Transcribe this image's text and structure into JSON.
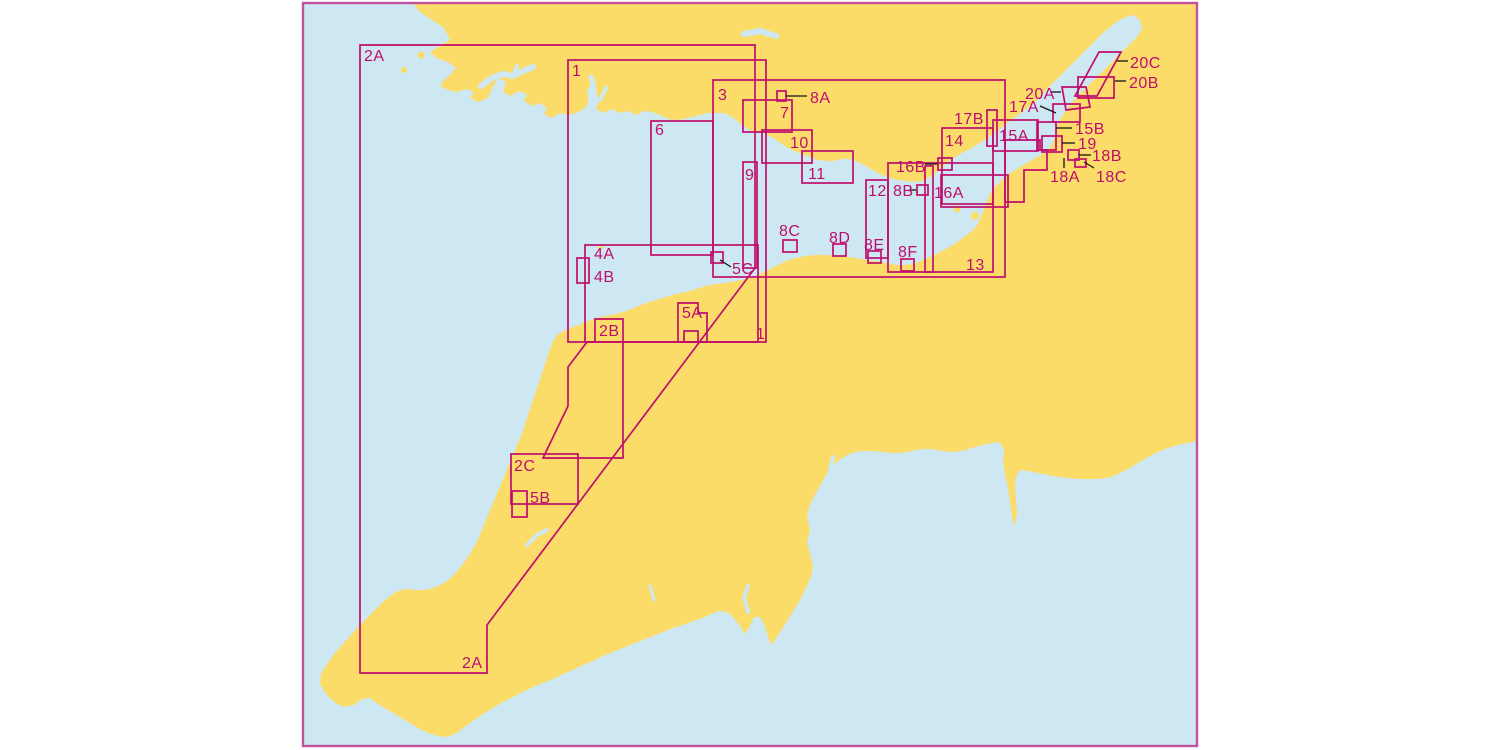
{
  "title": "Nautical chart index map",
  "colors": {
    "sea": "#cde8f2",
    "land": "#fbdc69",
    "line": "#c00d6d",
    "border": "#c3519c",
    "leader": "#151515",
    "label": "#c00d6d"
  },
  "frame": {
    "x": 303,
    "y": 3,
    "width": 894,
    "height": 743,
    "border_width": 2.4
  },
  "label_font_size": 16,
  "outline_width": 1.7,
  "land": [
    {
      "name": "mainland",
      "points": "413,3 420,12 432,20 444,28 450,40 440,46 430,52 436,58 448,62 456,68 450,75 444,80 440,86 448,90 458,92 466,89 474,92 470,98 478,102 488,98 492,88 498,78 506,82 503,92 510,96 519,91 527,94 524,101 532,106 540,103 547,108 544,114 551,118 560,113 568,115 576,113 584,109 589,101 587,91 592,83 596,91 599,101 596,109 604,113 612,109 620,113 628,111 636,115 644,111 652,112 660,115 668,119 676,120 684,119 692,117 700,115 708,113 716,113 724,113 732,117 740,123 748,129 752,131 758,133 764,133 770,136 778,141 786,147 794,151 802,154 810,157 818,160 826,161 834,161 842,159 850,159 858,162 866,166 874,171 882,175 890,178 898,180 906,181 914,182 922,181 930,177 938,171 946,164 954,158 962,153 970,149 978,144 986,139 994,133 1002,127 1010,121 1018,115 1026,109 1034,103 1040,97 1046,90 1054,82 1062,74 1070,66 1078,58 1086,50 1094,42 1102,34 1110,27 1118,21 1126,17 1134,15 1140,20 1142,28 1138,36 1130,44 1122,52 1114,60 1106,68 1098,76 1090,84 1082,92 1074,100 1068,108 1062,116 1058,124 1056,132 1054,140 1050,148 1042,154 1032,160 1022,166 1012,172 1004,178 996,186 990,194 986,204 982,214 978,224 972,231 964,237 956,243 946,249 936,254 926,259 916,263 906,265 896,265 886,263 876,261 866,260 856,258 846,257 836,256 826,255 816,255 806,256 796,258 786,261 776,266 766,271 756,276 746,279 736,281 726,283 716,284 706,286 696,289 686,292 676,294 666,297 656,300 646,303 636,307 626,311 616,314 606,316 596,318 586,322 576,326 566,330 558,334 553,341 549,352 545,364 541,376 537,388 533,400 529,412 525,424 521,436 516,448 511,460 506,472 501,484 496,496 491,508 486,520 481,532 476,544 470,554 463,564 455,574 446,582 436,587 426,590 416,590 406,589 398,591 390,596 382,603 374,611 366,619 358,627 350,636 342,645 334,654 327,664 321,674 320,684 326,694 334,702 344,707 354,705 362,699 370,698 378,704 388,710 398,716 408,722 418,728 428,733 438,736 448,737 457,733 464,727 473,721 483,714 493,708 503,702 513,697 523,692 533,687 543,683 553,679 563,674 573,670 583,665 593,661 603,656 613,652 623,648 633,644 643,640 653,636 663,632 673,628 683,625 693,621 703,618 711,614 719,611 727,612 734,618 740,626 745,634 750,626 754,617 760,617 765,626 768,637 771,645 777,637 784,626 792,613 800,600 806,588 811,577 813,566 810,554 807,542 810,530 807,517 810,505 816,493 822,482 828,472 834,464 842,458 852,453 862,451 872,451 882,452 892,453 902,453 912,451 922,449 932,449 942,451 952,452 962,451 972,448 982,445 992,443 1000,442 1004,450 1003,462 1005,474 1008,488 1010,502 1012,516 1014,527 1017,514 1016,500 1015,486 1016,476 1020,470 1028,471 1038,473 1048,475 1058,477 1068,478 1078,479 1088,479 1098,479 1108,478 1118,474 1128,469 1138,463 1148,457 1158,452 1168,448 1178,445 1188,443 1197,441 1197,3"
    }
  ],
  "islands": [
    {
      "name": "island-grassholm",
      "cx": 404,
      "cy": 70,
      "r": 3
    },
    {
      "name": "island-skomer",
      "cx": 421,
      "cy": 55,
      "r": 3.5
    },
    {
      "name": "island-lundy",
      "cx": 601,
      "cy": 247,
      "r": 2.5
    },
    {
      "name": "island-flat-holm",
      "cx": 957,
      "cy": 209,
      "r": 3.5
    },
    {
      "name": "island-steep-holm",
      "cx": 975,
      "cy": 216,
      "r": 4
    }
  ],
  "rivers": [
    {
      "name": "river-milford-haven",
      "points": "481,86 492,78 503,74 513,76 523,71 533,67",
      "w": 6
    },
    {
      "name": "river-milford-branch",
      "points": "513,76 517,66",
      "w": 4
    },
    {
      "name": "river-towy",
      "points": "590,100 594,88 591,77",
      "w": 5
    },
    {
      "name": "river-taf",
      "points": "600,100 606,88",
      "w": 4
    },
    {
      "name": "river-north-notch",
      "points": "744,34 760,31 776,36",
      "w": 6
    },
    {
      "name": "river-exe",
      "points": "830,470 833,457",
      "w": 4
    },
    {
      "name": "river-tamar",
      "points": "748,612 744,598 748,586",
      "w": 4
    },
    {
      "name": "river-fowey",
      "points": "654,600 650,586",
      "w": 3
    },
    {
      "name": "river-camel",
      "points": "527,545 537,535 547,530",
      "w": 4
    }
  ],
  "outlines": [
    {
      "id": "2A",
      "kind": "polygon",
      "points": "360,45 755,45 755,268 487,625 487,673 360,673"
    },
    {
      "id": "1",
      "kind": "rect",
      "x": 568,
      "y": 60,
      "w": 198,
      "h": 282
    },
    {
      "id": "3",
      "kind": "rect",
      "x": 713,
      "y": 80,
      "w": 292,
      "h": 197
    },
    {
      "id": "6",
      "kind": "rect",
      "x": 651,
      "y": 121,
      "w": 62,
      "h": 134
    },
    {
      "id": "4",
      "kind": "rect",
      "x": 585,
      "y": 245,
      "w": 173,
      "h": 97
    },
    {
      "id": "9",
      "kind": "rect",
      "x": 743,
      "y": 162,
      "w": 14,
      "h": 106
    },
    {
      "id": "7",
      "kind": "rect",
      "x": 743,
      "y": 100,
      "w": 49,
      "h": 32
    },
    {
      "id": "10",
      "kind": "rect",
      "x": 762,
      "y": 130,
      "w": 50,
      "h": 33
    },
    {
      "id": "11",
      "kind": "rect",
      "x": 802,
      "y": 151,
      "w": 51,
      "h": 32
    },
    {
      "id": "12",
      "kind": "rect",
      "x": 866,
      "y": 180,
      "w": 22,
      "h": 78
    },
    {
      "id": "13",
      "kind": "rect",
      "x": 888,
      "y": 163,
      "w": 105,
      "h": 109
    },
    {
      "id": "strip-13a",
      "kind": "rect",
      "x": 925,
      "y": 166,
      "w": 8,
      "h": 106
    },
    {
      "id": "14",
      "kind": "rect",
      "x": 942,
      "y": 128,
      "w": 51,
      "h": 76
    },
    {
      "id": "16A",
      "kind": "rect",
      "x": 941,
      "y": 175,
      "w": 67,
      "h": 32
    },
    {
      "id": "16B-box",
      "kind": "rect",
      "x": 938,
      "y": 158,
      "w": 14,
      "h": 12
    },
    {
      "id": "8B-box",
      "kind": "rect",
      "x": 917,
      "y": 185,
      "w": 11,
      "h": 10
    },
    {
      "id": "17B-box",
      "kind": "rect",
      "x": 987,
      "y": 110,
      "w": 10,
      "h": 36
    },
    {
      "id": "15A",
      "kind": "rect",
      "x": 993,
      "y": 120,
      "w": 45,
      "h": 31
    },
    {
      "id": "15B-box",
      "kind": "rect",
      "x": 1037,
      "y": 122,
      "w": 19,
      "h": 28
    },
    {
      "id": "19-box",
      "kind": "rect",
      "x": 1042,
      "y": 136,
      "w": 20,
      "h": 16
    },
    {
      "id": "18B-box",
      "kind": "rect",
      "x": 1068,
      "y": 150,
      "w": 11,
      "h": 10
    },
    {
      "id": "18C-box",
      "kind": "rect",
      "x": 1075,
      "y": 159,
      "w": 11,
      "h": 8
    },
    {
      "id": "avon-step",
      "kind": "polygon",
      "points": "1005,140 1040,140 1040,150 1047,150 1047,170 1024,170 1024,202 1005,202"
    },
    {
      "id": "20C-band",
      "kind": "polygon",
      "points": "1099,52 1121,52 1097,96 1075,96"
    },
    {
      "id": "20B-box",
      "kind": "rect",
      "x": 1078,
      "y": 77,
      "w": 36,
      "h": 21
    },
    {
      "id": "20A-box",
      "kind": "polygon",
      "points": "1062,87 1086,87 1090,107 1066,110"
    },
    {
      "id": "17A-box",
      "kind": "rect",
      "x": 1053,
      "y": 104,
      "w": 27,
      "h": 18
    },
    {
      "id": "2B",
      "kind": "polygon",
      "points": "595,319 623,319 623,458 543,458 568,406 568,367 587,342 595,342"
    },
    {
      "id": "2C",
      "kind": "rect",
      "x": 511,
      "y": 454,
      "w": 67,
      "h": 50
    },
    {
      "id": "5B-box",
      "kind": "rect",
      "x": 512,
      "y": 491,
      "w": 15,
      "h": 26
    },
    {
      "id": "5A",
      "kind": "polygon",
      "points": "678,303 698,303 698,313 707,313 707,342 678,342"
    },
    {
      "id": "5A-inner",
      "kind": "rect",
      "x": 684,
      "y": 331,
      "w": 14,
      "h": 11
    },
    {
      "id": "5C-box",
      "kind": "rect",
      "x": 711,
      "y": 252,
      "w": 12,
      "h": 11
    },
    {
      "id": "4B-box",
      "kind": "rect",
      "x": 577,
      "y": 258,
      "w": 12,
      "h": 25
    },
    {
      "id": "8A-box",
      "kind": "rect",
      "x": 777,
      "y": 91,
      "w": 9,
      "h": 10
    },
    {
      "id": "8C-box",
      "kind": "rect",
      "x": 783,
      "y": 240,
      "w": 14,
      "h": 12
    },
    {
      "id": "8D-box",
      "kind": "rect",
      "x": 833,
      "y": 244,
      "w": 13,
      "h": 12
    },
    {
      "id": "8E-box",
      "kind": "rect",
      "x": 868,
      "y": 251,
      "w": 13,
      "h": 12
    },
    {
      "id": "8F-box",
      "kind": "rect",
      "x": 901,
      "y": 259,
      "w": 13,
      "h": 12
    }
  ],
  "leaders": [
    {
      "for": "8A",
      "x1": 786,
      "y1": 96,
      "x2": 807,
      "y2": 96
    },
    {
      "for": "5C",
      "x1": 720,
      "y1": 260,
      "x2": 731,
      "y2": 267
    },
    {
      "for": "16B",
      "x1": 925,
      "y1": 164,
      "x2": 937,
      "y2": 164
    },
    {
      "for": "8B",
      "x1": 910,
      "y1": 190,
      "x2": 916,
      "y2": 190
    },
    {
      "for": "15B",
      "x1": 1056,
      "y1": 128,
      "x2": 1072,
      "y2": 128
    },
    {
      "for": "19",
      "x1": 1062,
      "y1": 143,
      "x2": 1075,
      "y2": 143
    },
    {
      "for": "18B",
      "x1": 1079,
      "y1": 155,
      "x2": 1091,
      "y2": 155
    },
    {
      "for": "18A",
      "x1": 1064,
      "y1": 158,
      "x2": 1064,
      "y2": 168
    },
    {
      "for": "18C",
      "x1": 1094,
      "y1": 168,
      "x2": 1084,
      "y2": 162
    },
    {
      "for": "17A",
      "x1": 1040,
      "y1": 106,
      "x2": 1056,
      "y2": 113
    },
    {
      "for": "20A",
      "x1": 1051,
      "y1": 92,
      "x2": 1061,
      "y2": 92
    },
    {
      "for": "20B",
      "x1": 1115,
      "y1": 81,
      "x2": 1126,
      "y2": 81
    },
    {
      "for": "20C",
      "x1": 1117,
      "y1": 61,
      "x2": 1128,
      "y2": 61
    }
  ],
  "labels": [
    {
      "id": "2A-top",
      "text": "2A",
      "x": 364,
      "y": 61
    },
    {
      "id": "1-top",
      "text": "1",
      "x": 572,
      "y": 76
    },
    {
      "id": "3",
      "text": "3",
      "x": 718,
      "y": 100
    },
    {
      "id": "6",
      "text": "6",
      "x": 655,
      "y": 135
    },
    {
      "id": "7",
      "text": "7",
      "x": 780,
      "y": 118
    },
    {
      "id": "8A",
      "text": "8A",
      "x": 810,
      "y": 103
    },
    {
      "id": "10",
      "text": "10",
      "x": 790,
      "y": 148
    },
    {
      "id": "9",
      "text": "9",
      "x": 745,
      "y": 180
    },
    {
      "id": "11",
      "text": "11",
      "x": 808,
      "y": 179
    },
    {
      "id": "12",
      "text": "12",
      "x": 868,
      "y": 196
    },
    {
      "id": "8B",
      "text": "8B",
      "x": 893,
      "y": 196
    },
    {
      "id": "16B",
      "text": "16B",
      "x": 896,
      "y": 172
    },
    {
      "id": "16A",
      "text": "16A",
      "x": 934,
      "y": 198
    },
    {
      "id": "14",
      "text": "14",
      "x": 945,
      "y": 146
    },
    {
      "id": "13",
      "text": "13",
      "x": 966,
      "y": 270
    },
    {
      "id": "17B",
      "text": "17B",
      "x": 954,
      "y": 124
    },
    {
      "id": "15A",
      "text": "15A",
      "x": 999,
      "y": 141
    },
    {
      "id": "15B",
      "text": "15B",
      "x": 1075,
      "y": 134
    },
    {
      "id": "19",
      "text": "19",
      "x": 1078,
      "y": 149
    },
    {
      "id": "18B",
      "text": "18B",
      "x": 1092,
      "y": 161
    },
    {
      "id": "18A",
      "text": "18A",
      "x": 1050,
      "y": 182
    },
    {
      "id": "18C",
      "text": "18C",
      "x": 1096,
      "y": 182
    },
    {
      "id": "20A",
      "text": "20A",
      "x": 1025,
      "y": 99
    },
    {
      "id": "20B",
      "text": "20B",
      "x": 1129,
      "y": 88
    },
    {
      "id": "20C",
      "text": "20C",
      "x": 1130,
      "y": 68
    },
    {
      "id": "17A",
      "text": "17A",
      "x": 1009,
      "y": 112
    },
    {
      "id": "8C",
      "text": "8C",
      "x": 779,
      "y": 236
    },
    {
      "id": "8D",
      "text": "8D",
      "x": 829,
      "y": 243
    },
    {
      "id": "8E",
      "text": "8E",
      "x": 864,
      "y": 250
    },
    {
      "id": "8F",
      "text": "8F",
      "x": 898,
      "y": 257
    },
    {
      "id": "4A",
      "text": "4A",
      "x": 594,
      "y": 259
    },
    {
      "id": "4B",
      "text": "4B",
      "x": 594,
      "y": 282
    },
    {
      "id": "5C",
      "text": "5C",
      "x": 732,
      "y": 274
    },
    {
      "id": "5A",
      "text": "5A",
      "x": 682,
      "y": 318
    },
    {
      "id": "2B",
      "text": "2B",
      "x": 599,
      "y": 336
    },
    {
      "id": "2C",
      "text": "2C",
      "x": 514,
      "y": 471
    },
    {
      "id": "5B",
      "text": "5B",
      "x": 530,
      "y": 503
    },
    {
      "id": "2A-bottom",
      "text": "2A",
      "x": 462,
      "y": 668
    },
    {
      "id": "1-bottom",
      "text": "1",
      "x": 756,
      "y": 339
    }
  ]
}
